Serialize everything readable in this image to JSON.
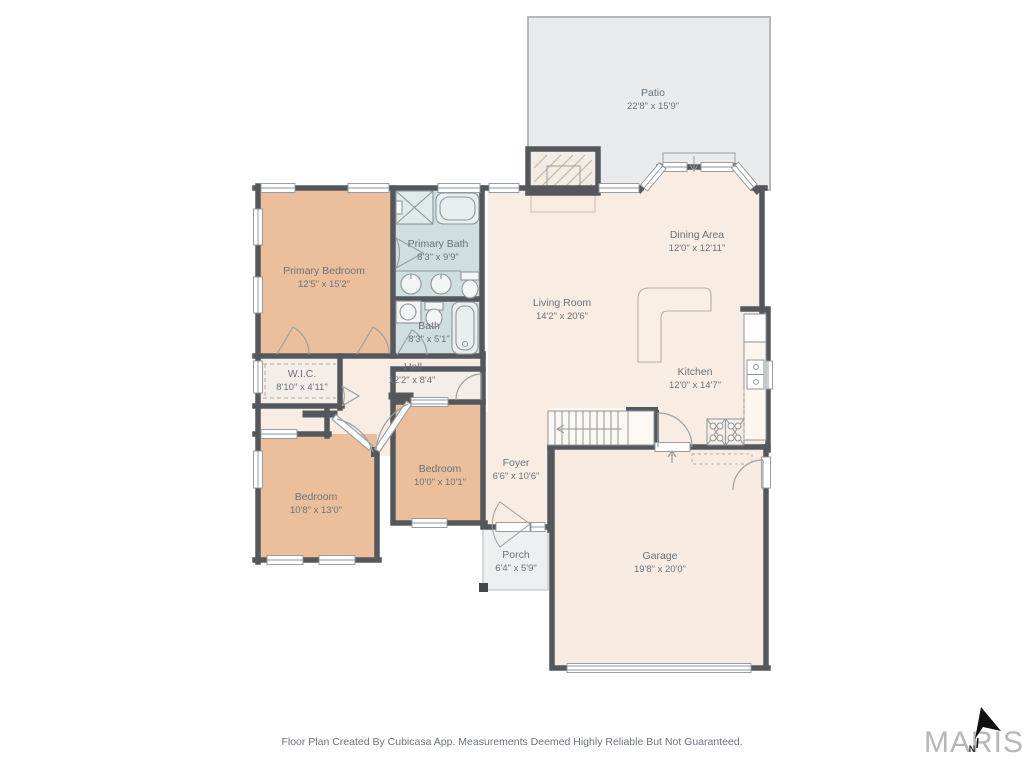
{
  "rooms": {
    "patio": {
      "name": "Patio",
      "dims": "22'8\" x 15'9\""
    },
    "primary_bedroom": {
      "name": "Primary Bedroom",
      "dims": "12'5\" x 15'2\""
    },
    "primary_bath": {
      "name": "Primary Bath",
      "dims": "8'3\" x 9'9\""
    },
    "bath": {
      "name": "Bath",
      "dims": "8'3\" x 5'1\""
    },
    "dining": {
      "name": "Dining Area",
      "dims": "12'0\" x 12'11\""
    },
    "living": {
      "name": "Living Room",
      "dims": "14'2\" x 20'6\""
    },
    "kitchen": {
      "name": "Kitchen",
      "dims": "12'0\" x 14'7\""
    },
    "wic": {
      "name": "W.I.C.",
      "dims": "8'10\" x 4'11\""
    },
    "hall": {
      "name": "Hall",
      "dims": "12'2\" x 8'4\""
    },
    "bedroom_right": {
      "name": "Bedroom",
      "dims": "10'0\" x 10'1\""
    },
    "bedroom_left": {
      "name": "Bedroom",
      "dims": "10'8\" x 13'0\""
    },
    "foyer": {
      "name": "Foyer",
      "dims": "6'6\" x 10'6\""
    },
    "porch": {
      "name": "Porch",
      "dims": "6'4\" x 5'9\""
    },
    "garage": {
      "name": "Garage",
      "dims": "19'8\" x 20'0\""
    }
  },
  "footer": {
    "disclaimer": "Floor Plan Created By Cubicasa App. Measurements Deemed Highly Reliable But Not Guaranteed."
  },
  "branding": {
    "logo_text": "MARIS",
    "north_label": "N"
  },
  "colors": {
    "wall": "#54585c",
    "floor": "#f8ece3",
    "bedroom_fill": "#ecbf9c",
    "bath_fill": "#cfdfdf",
    "outdoor_fill": "#e9ebed",
    "closet_fill": "#f4eee8",
    "label_text": "#68727c",
    "fixture_line": "#8f959a",
    "furniture_line": "#bcae9e"
  }
}
